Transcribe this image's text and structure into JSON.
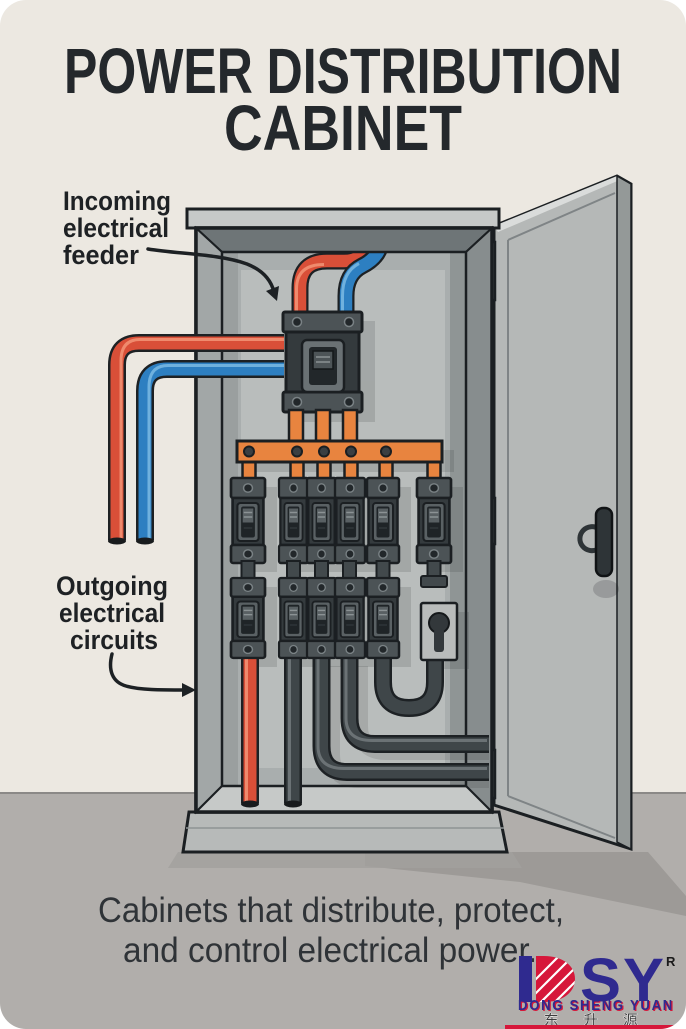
{
  "poster": {
    "title_line1": "POWER DISTRIBUTION",
    "title_line2": "CABINET",
    "caption_line1": "Cabinets that distribute, protect,",
    "caption_line2": "and control electrical power."
  },
  "annotations": {
    "incoming_line1": "Incoming",
    "incoming_line2": "electrical",
    "incoming_line3": "feeder",
    "outgoing_line1": "Outgoing",
    "outgoing_line2": "electrical",
    "outgoing_line3": "circuits"
  },
  "logo": {
    "letters_sy": "SY",
    "registered_mark": "R",
    "company_name": "DONG SHENG YUAN",
    "company_name_cn": "东 升 源"
  },
  "colors": {
    "wire_red": "#D94F38",
    "wire_blue": "#2D7FC1",
    "wire_dark": "#3F4649",
    "busbar_orange": "#E8843F",
    "logo_blue": "#2F2A8F",
    "logo_red": "#D6173A",
    "wall": "#ECE8E1",
    "floor": "#B1AEAB"
  }
}
